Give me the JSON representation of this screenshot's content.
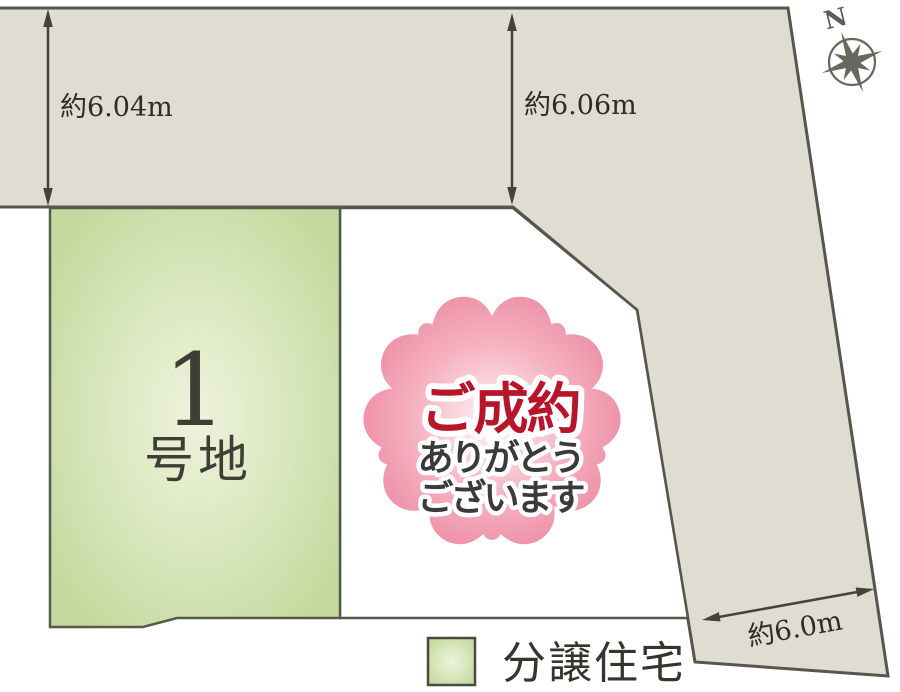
{
  "map": {
    "compass": {
      "label": "N"
    },
    "dimensions": {
      "left": "約6.04m",
      "middle": "約6.06m",
      "bottom_right": "約6.0m"
    },
    "lot1": {
      "number": "1",
      "suffix": "号地"
    },
    "sold_sticker": {
      "title": "ご成約",
      "thanks_line1": "ありがとう",
      "thanks_line2": "ございます"
    },
    "legend": {
      "sale_housing": "分譲住宅"
    },
    "colors": {
      "road": "#dfddd1",
      "outline": "#56564d",
      "lot_green": "#c3d99e",
      "lot_green_light": "#eef3dc",
      "petal_pink": "#ed8ea6",
      "sold_red": "#b8142a",
      "dim_text": "#2d2d27"
    }
  }
}
